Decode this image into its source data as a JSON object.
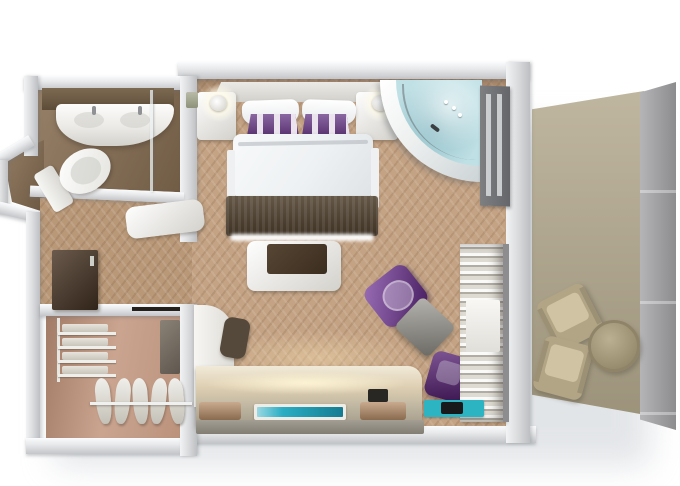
{
  "scene": {
    "title": "Hotel suite 3D floor plan render",
    "view": "top-down 3D rendering",
    "canvas": {
      "width": 680,
      "height": 486
    },
    "background": "#ffffff"
  },
  "palette": {
    "wall_light": "#f5f6f7",
    "wall_mid": "#d9dbdd",
    "wall_dark": "#bfc1c4",
    "bedroom_floor": "#c4a384",
    "entry_floor": "#b99878",
    "bathroom_floor": "#8a7054",
    "closet_floor": "#c49a83",
    "balcony_floor": "#b2a78c",
    "balcony_wall": "#9c9c9f",
    "bed_linen": "#f4f6f7",
    "pillow_purple": "#5e2d7e",
    "runner_brown": "#4f402e",
    "tub_water": "#bfe0e5",
    "accent_purple": "#6f2f96",
    "accent_purple_dark": "#531d70",
    "table_gray": "#8f8c84",
    "console_glow": "#f6ecd4",
    "tv_teal": "#1fa9c0",
    "teal_mat": "#2cb4c2",
    "tray_wood": "#b78e69",
    "towel_beige": "#dfdcd4",
    "minibar_brown": "#4a3626",
    "lounge_khaki": "#b1a585"
  },
  "rooms": {
    "bedroom": {
      "label": "bedroom",
      "furniture": [
        "double-bed",
        "pillows-white",
        "pillows-purple-striped",
        "bed-runner",
        "nightstand-left",
        "nightstand-right",
        "wall-lamp-left",
        "wall-lamp-right",
        "corner-bathtub",
        "balcony-door-panel",
        "bench-with-tray",
        "armchair-purple",
        "side-table-gray",
        "chair-purple",
        "towel-shelving",
        "desk-return",
        "desk-chair",
        "media-console",
        "tv-screen",
        "trays",
        "teal-mat"
      ]
    },
    "bathroom": {
      "label": "bathroom",
      "furniture": [
        "vanity-counter",
        "double-sink",
        "toilet",
        "shower-glass",
        "decor-object"
      ]
    },
    "closet": {
      "label": "walk-in-closet",
      "furniture": [
        "shelf-unit-folded-clothes",
        "hanging-rail",
        "garments-on-hangers",
        "mirror-panel",
        "minibar-cabinet"
      ]
    },
    "entry": {
      "label": "entry-hall",
      "furniture": [
        "entry-bench"
      ]
    },
    "balcony": {
      "label": "balcony",
      "furniture": [
        "lounge-chair-1",
        "lounge-chair-2",
        "round-table",
        "privacy-partition"
      ]
    }
  },
  "bed": {
    "pillows_white": 2,
    "pillows_striped": 2,
    "stripe_colors": [
      "#5e2d7e",
      "#ebe4ef"
    ]
  },
  "closet_details": {
    "shelf_count": 4,
    "hanger_count": 5
  },
  "balcony_details": {
    "chair_count": 2,
    "table_shape": "round"
  }
}
